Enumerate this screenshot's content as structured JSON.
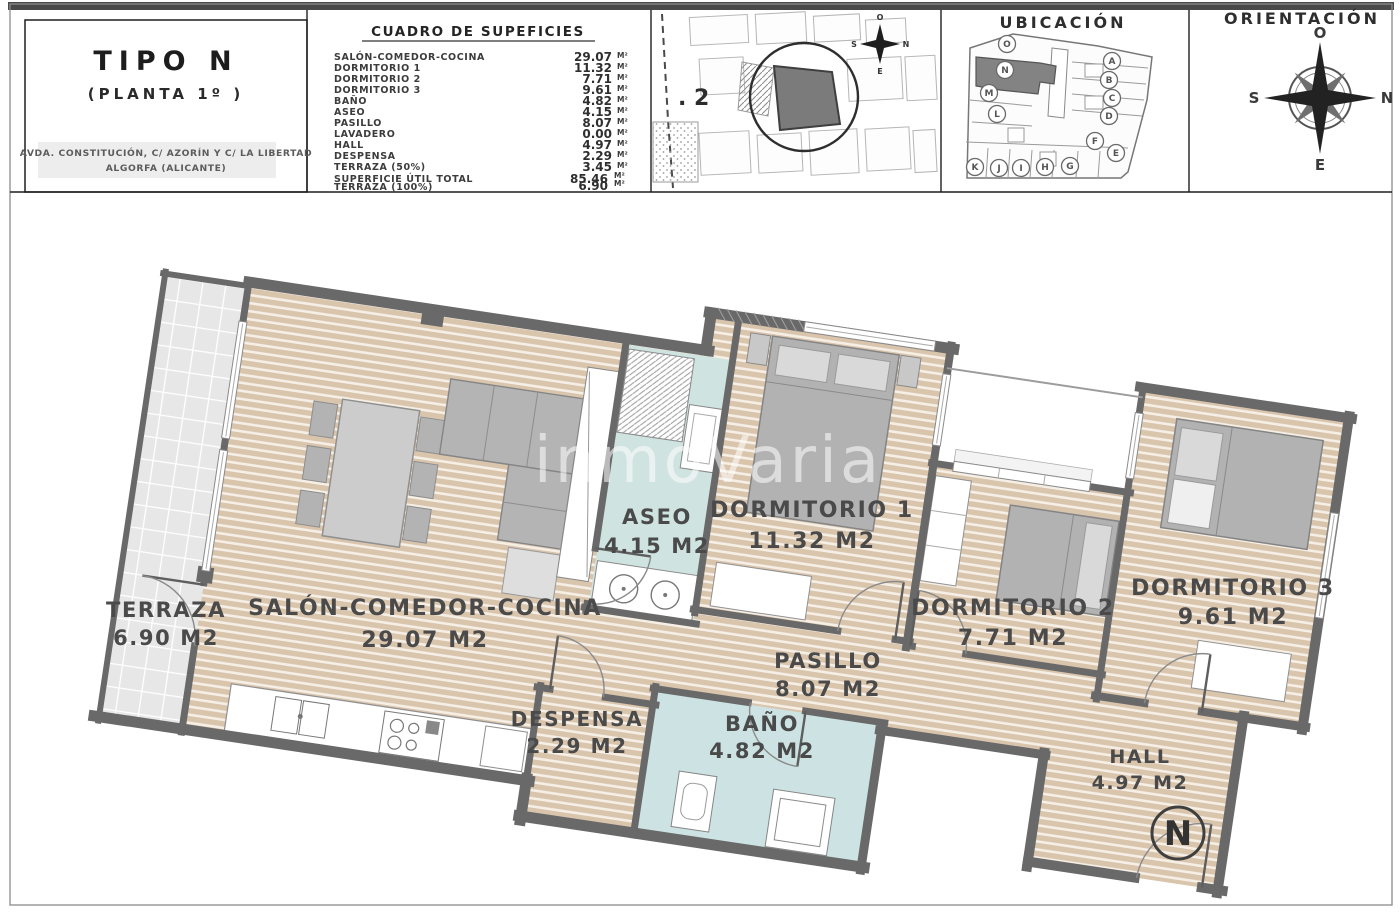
{
  "header": {
    "left": {
      "type_title": "TIPO N",
      "floor_subtitle": "(PLANTA 1º )",
      "address_line1": "AVDA. CONSTITUCIÓN, C/ AZORÍN Y C/ LA LIBERTAD",
      "address_line2": "ALGORFA (ALICANTE)"
    },
    "table": {
      "title": "CUADRO DE SUPEFICIES",
      "unit": "M²",
      "rows": [
        {
          "label": "SALÓN-COMEDOR-COCINA",
          "value": "29.07"
        },
        {
          "label": "DORMITORIO 1",
          "value": "11.32"
        },
        {
          "label": "DORMITORIO 2",
          "value": "7.71"
        },
        {
          "label": "DORMITORIO 3",
          "value": "9.61"
        },
        {
          "label": "BAÑO",
          "value": "4.82"
        },
        {
          "label": "ASEO",
          "value": "4.15"
        },
        {
          "label": "PASILLO",
          "value": "8.07"
        },
        {
          "label": "LAVADERO",
          "value": "0.00"
        },
        {
          "label": "HALL",
          "value": "4.97"
        },
        {
          "label": "DESPENSA",
          "value": "2.29"
        },
        {
          "label": "TERRAZA (50%)",
          "value": "3.45"
        }
      ],
      "totals": [
        {
          "label": "SUPERFICIE ÚTIL TOTAL",
          "value": "85.46"
        },
        {
          "label": "TERRAZA (100%)",
          "value": "6.90"
        }
      ]
    },
    "siteplan": {
      "parcel_label": ". 2",
      "compass": {
        "top": "O",
        "right": "N",
        "left": "S",
        "bottom": "E"
      }
    },
    "ubicacion": {
      "title": "UBICACIÓN",
      "highlighted_unit": "N",
      "units": [
        "O",
        "N",
        "M",
        "L",
        "A",
        "B",
        "C",
        "D",
        "F",
        "E",
        "K",
        "J",
        "I",
        "H",
        "G"
      ]
    },
    "orientacion": {
      "title": "ORIENTACIÓN",
      "compass": {
        "top": "O",
        "right": "N",
        "left": "S",
        "bottom": "E"
      }
    }
  },
  "plan": {
    "watermark": "inmoVaria",
    "unit_marker": "N",
    "rooms": [
      {
        "name": "TERRAZA",
        "area": "6.90 M2"
      },
      {
        "name": "SALÓN-COMEDOR-COCINA",
        "area": "29.07 M2"
      },
      {
        "name": "ASEO",
        "area": "4.15 M2"
      },
      {
        "name": "DORMITORIO 1",
        "area": "11.32 M2"
      },
      {
        "name": "DORMITORIO 2",
        "area": "7.71 M2"
      },
      {
        "name": "DORMITORIO 3",
        "area": "9.61 M2"
      },
      {
        "name": "PASILLO",
        "area": "8.07 M2"
      },
      {
        "name": "DESPENSA",
        "area": "2.29 M2"
      },
      {
        "name": "BAÑO",
        "area": "4.82 M2"
      },
      {
        "name": "HALL",
        "area": "4.97 M2"
      }
    ]
  },
  "colors": {
    "wall": "#696969",
    "wood_floor": "#d9c4ac",
    "bath_floor": "#cfe3e0",
    "terrace_tile": "#e9e9e9",
    "furniture": "#b4b4b4",
    "highlighted_unit": "#838383"
  }
}
